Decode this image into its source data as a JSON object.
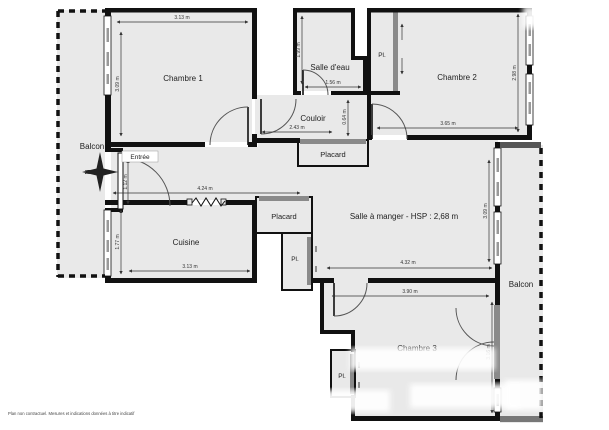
{
  "labels": {
    "chambre1": "Chambre 1",
    "chambre2": "Chambre 2",
    "chambre3": "Chambre 3",
    "cuisine": "Cuisine",
    "salle_eau": "Salle d'eau",
    "sejour": "Salle à manger - HSP : 2,68 m",
    "couloir": "Couloir",
    "entree": "Entrée",
    "balcon_left": "Balcon",
    "balcon_right": "Balcon",
    "placard_couloir": "Placard",
    "placard_cuisine": "Placard",
    "pl_top": "Pl.",
    "pl_sejour": "Pl.",
    "pl_chambre3": "Pl."
  },
  "dimensions": {
    "chambre1_w": "3.13 m",
    "chambre1_h": "3.09 m",
    "salle_eau_h": "1.99 m",
    "salle_eau_w": "1.56 m",
    "couloir_w": "2.43 m",
    "couloir_h": "0.64 m",
    "chambre2_w": "3.65 m",
    "chambre2_h": "2.98 m",
    "cuisine_top_w": "4.24 m",
    "cuisine_h": "1.77 m",
    "cuisine_w": "3.13 m",
    "entree_h": "1.12 m",
    "sejour_w": "4.32 m",
    "sejour_h": "3.09 m",
    "chambre3_w": "3.90 m",
    "chambre3_h": "3.16 m"
  },
  "compass": {
    "letter": "N"
  },
  "footer": {
    "disclaimer": "Plan non contractuel. Mesures et indications données à titre indicatif"
  },
  "colors": {
    "room_fill": "#e9e9e9",
    "wall": "#111111",
    "slider": "#8a8a8a",
    "dim_text": "#333333"
  }
}
